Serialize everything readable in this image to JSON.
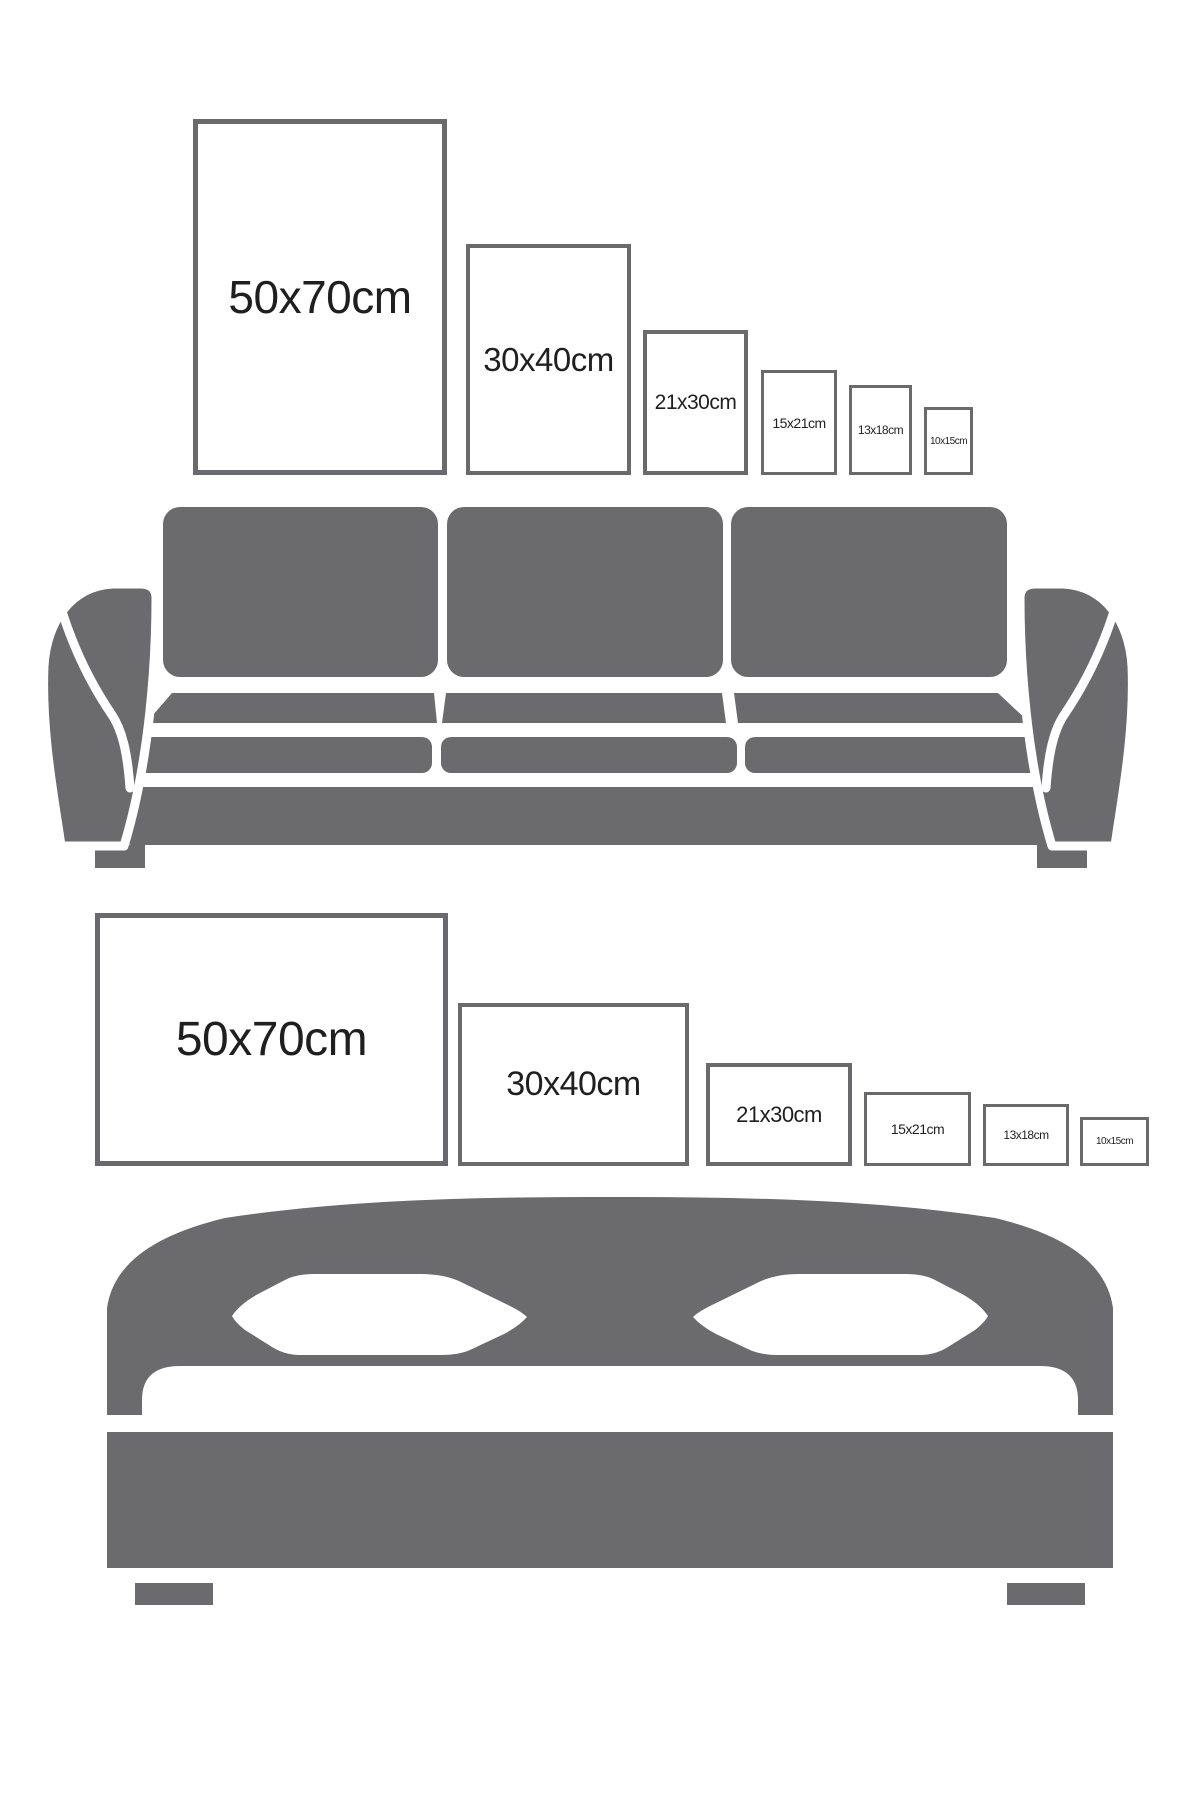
{
  "page": {
    "background_color": "#ffffff",
    "description_labels_only": true
  },
  "colors": {
    "furniture_gray": "#6b6b6e",
    "frame_border_gray": "#6a6a6e",
    "label_text": "#1f1f1f"
  },
  "sections": {
    "sofa": {
      "furniture_icon": "sofa-icon",
      "frame_orientation": "portrait",
      "frames": [
        {
          "label": "50x70cm"
        },
        {
          "label": "30x40cm"
        },
        {
          "label": "21x30cm"
        },
        {
          "label": "15x21cm"
        },
        {
          "label": "13x18cm"
        },
        {
          "label": "10x15cm"
        }
      ]
    },
    "bed": {
      "furniture_icon": "bed-icon",
      "frame_orientation": "landscape",
      "frames": [
        {
          "label": "50x70cm"
        },
        {
          "label": "30x40cm"
        },
        {
          "label": "21x30cm"
        },
        {
          "label": "15x21cm"
        },
        {
          "label": "13x18cm"
        },
        {
          "label": "10x15cm"
        }
      ]
    }
  }
}
